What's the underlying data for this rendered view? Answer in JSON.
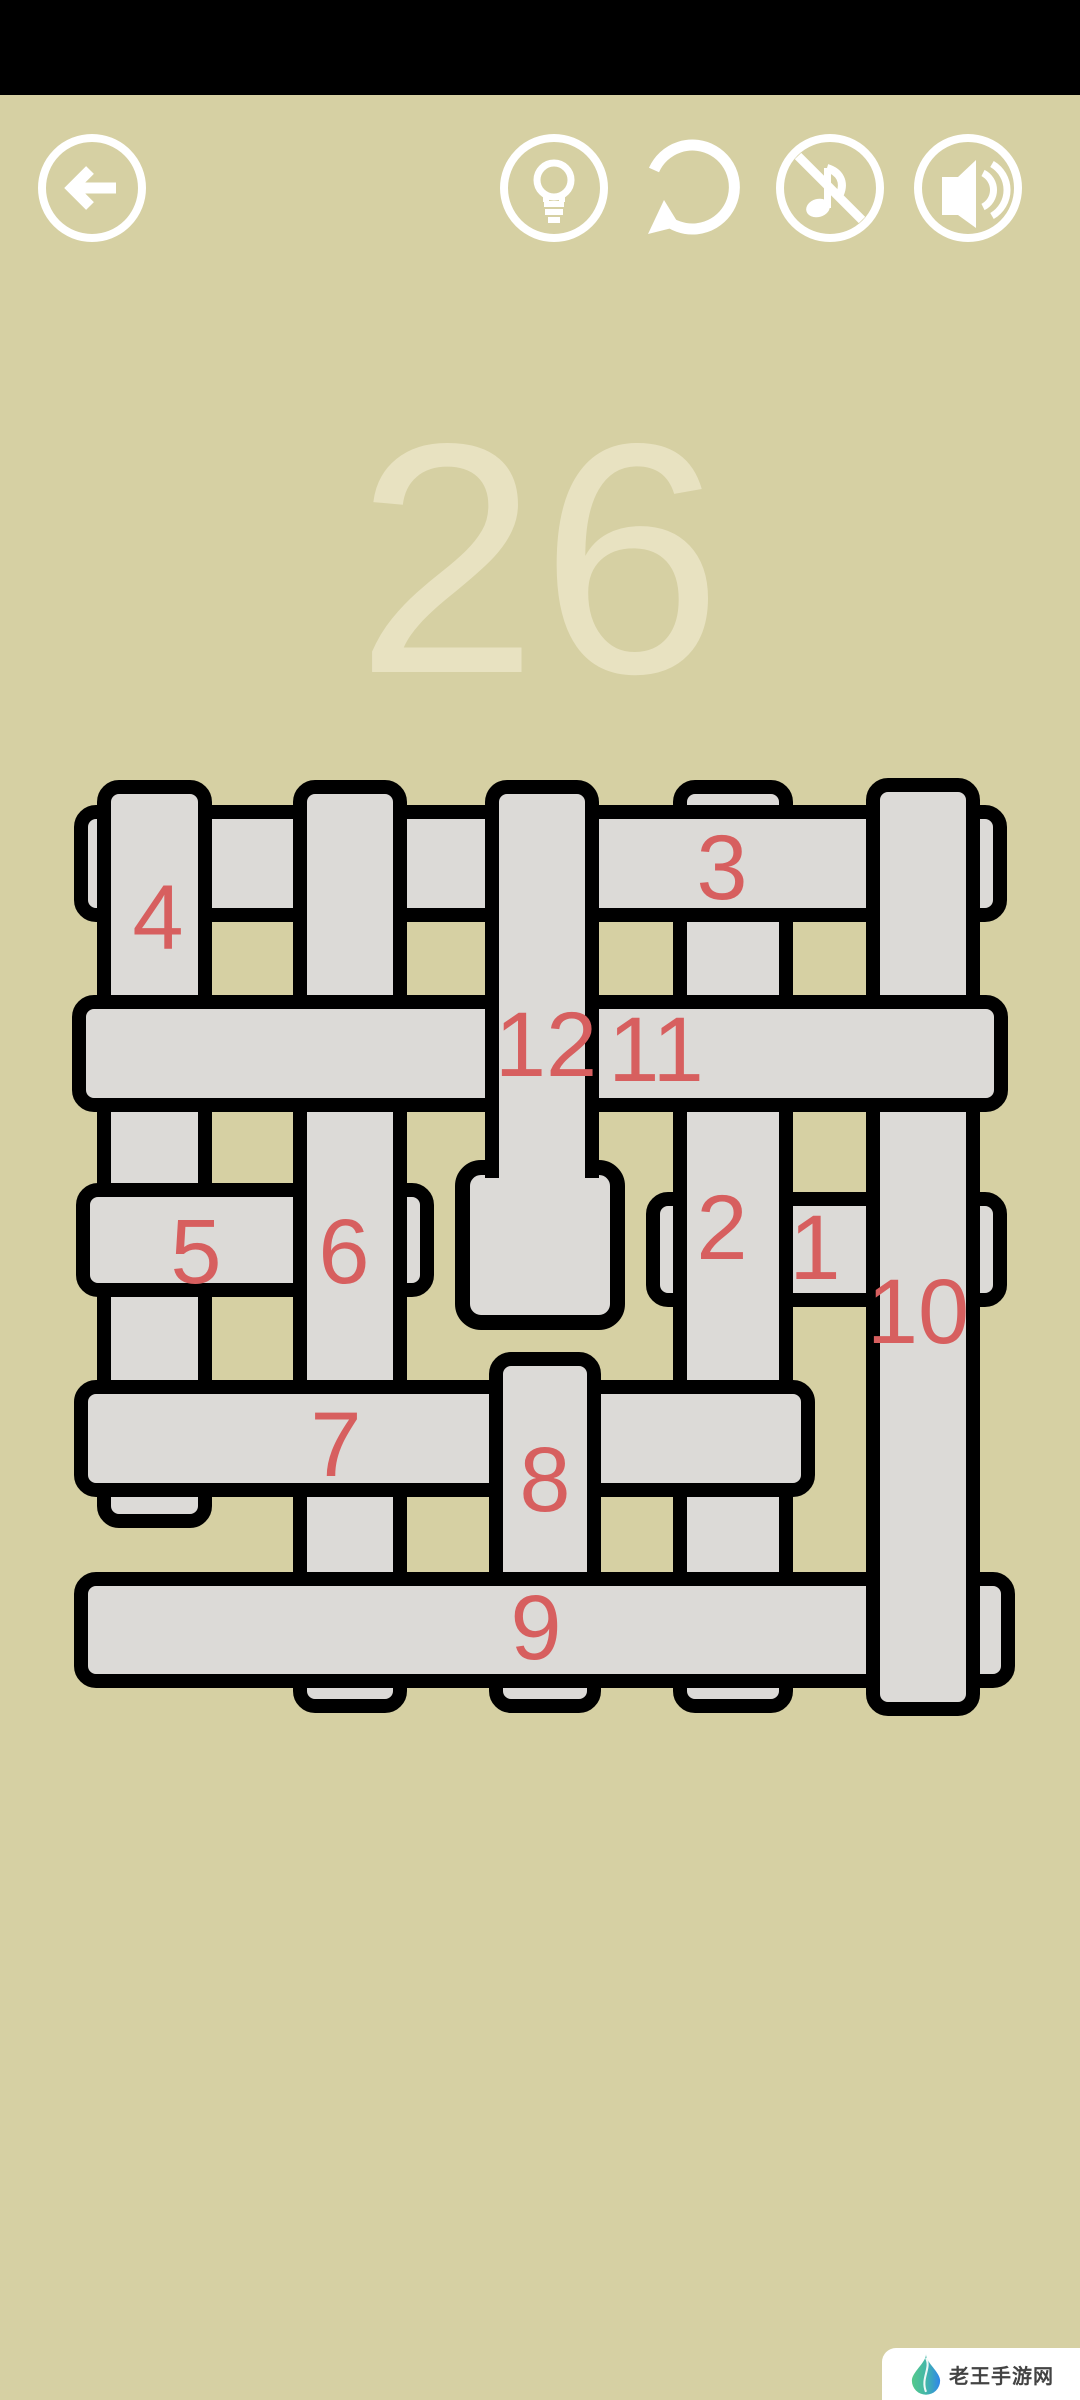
{
  "colors": {
    "background": "#d6d0a3",
    "top_bar": "#000000",
    "icon": "#ffffff",
    "strip_fill": "#dcdad7",
    "strip_border": "#000000",
    "strip_label": "#d75f5f",
    "level_number": "#e8e2c1",
    "watermark_bg": "#ffffff",
    "watermark_text": "#434343"
  },
  "toolbar": {
    "back_icon": "back-arrow",
    "hint_icon": "lightbulb",
    "restart_icon": "restart-arrow",
    "music_icon": "music-note-off",
    "sound_icon": "speaker-on"
  },
  "level": {
    "number": "26"
  },
  "puzzle": {
    "description": "weave puzzle with 12 numbered interlaced strips, z-order equals strip number",
    "strips": [
      {
        "id": 1,
        "label": "1",
        "type": "h",
        "x": 646,
        "y": 1192,
        "w": 361,
        "h": 115,
        "label_x": 815,
        "label_y": 1248
      },
      {
        "id": 2,
        "label": "2",
        "type": "v",
        "x": 673,
        "y": 780,
        "w": 120,
        "h": 933,
        "label_x": 722,
        "label_y": 1228
      },
      {
        "id": 3,
        "label": "3",
        "type": "h",
        "x": 74,
        "y": 805,
        "w": 933,
        "h": 117,
        "label_x": 722,
        "label_y": 868
      },
      {
        "id": 4,
        "label": "4",
        "type": "v",
        "x": 97,
        "y": 780,
        "w": 115,
        "h": 748,
        "label_x": 158,
        "label_y": 918
      },
      {
        "id": 5,
        "label": "5",
        "type": "h",
        "x": 76,
        "y": 1183,
        "w": 358,
        "h": 114,
        "label_x": 196,
        "label_y": 1252
      },
      {
        "id": 6,
        "label": "6",
        "type": "v",
        "x": 293,
        "y": 780,
        "w": 114,
        "h": 933,
        "label_x": 344,
        "label_y": 1252
      },
      {
        "id": 7,
        "label": "7",
        "type": "h",
        "x": 74,
        "y": 1380,
        "w": 741,
        "h": 117,
        "label_x": 336,
        "label_y": 1445
      },
      {
        "id": 8,
        "label": "8",
        "type": "v",
        "x": 489,
        "y": 1352,
        "w": 112,
        "h": 361,
        "label_x": 545,
        "label_y": 1480
      },
      {
        "id": 9,
        "label": "9",
        "type": "h",
        "x": 74,
        "y": 1572,
        "w": 941,
        "h": 116,
        "label_x": 536,
        "label_y": 1628
      },
      {
        "id": 10,
        "label": "10",
        "type": "v",
        "x": 866,
        "y": 778,
        "w": 114,
        "h": 938,
        "label_x": 918,
        "label_y": 1312
      },
      {
        "id": 11,
        "label": "11",
        "type": "h",
        "x": 72,
        "y": 995,
        "w": 936,
        "h": 117,
        "label_x": 656,
        "label_y": 1050
      },
      {
        "id": 12,
        "label": null,
        "type": "handle",
        "x": 455,
        "y": 1160,
        "w": 170,
        "h": 170,
        "handle": true
      },
      {
        "id": 12,
        "label": "12",
        "type": "v",
        "x": 485,
        "y": 780,
        "w": 114,
        "h": 398,
        "no_bottom_border": true,
        "label_x": 546,
        "label_y": 1045
      }
    ]
  },
  "watermark": {
    "brand": "老王手游网"
  }
}
